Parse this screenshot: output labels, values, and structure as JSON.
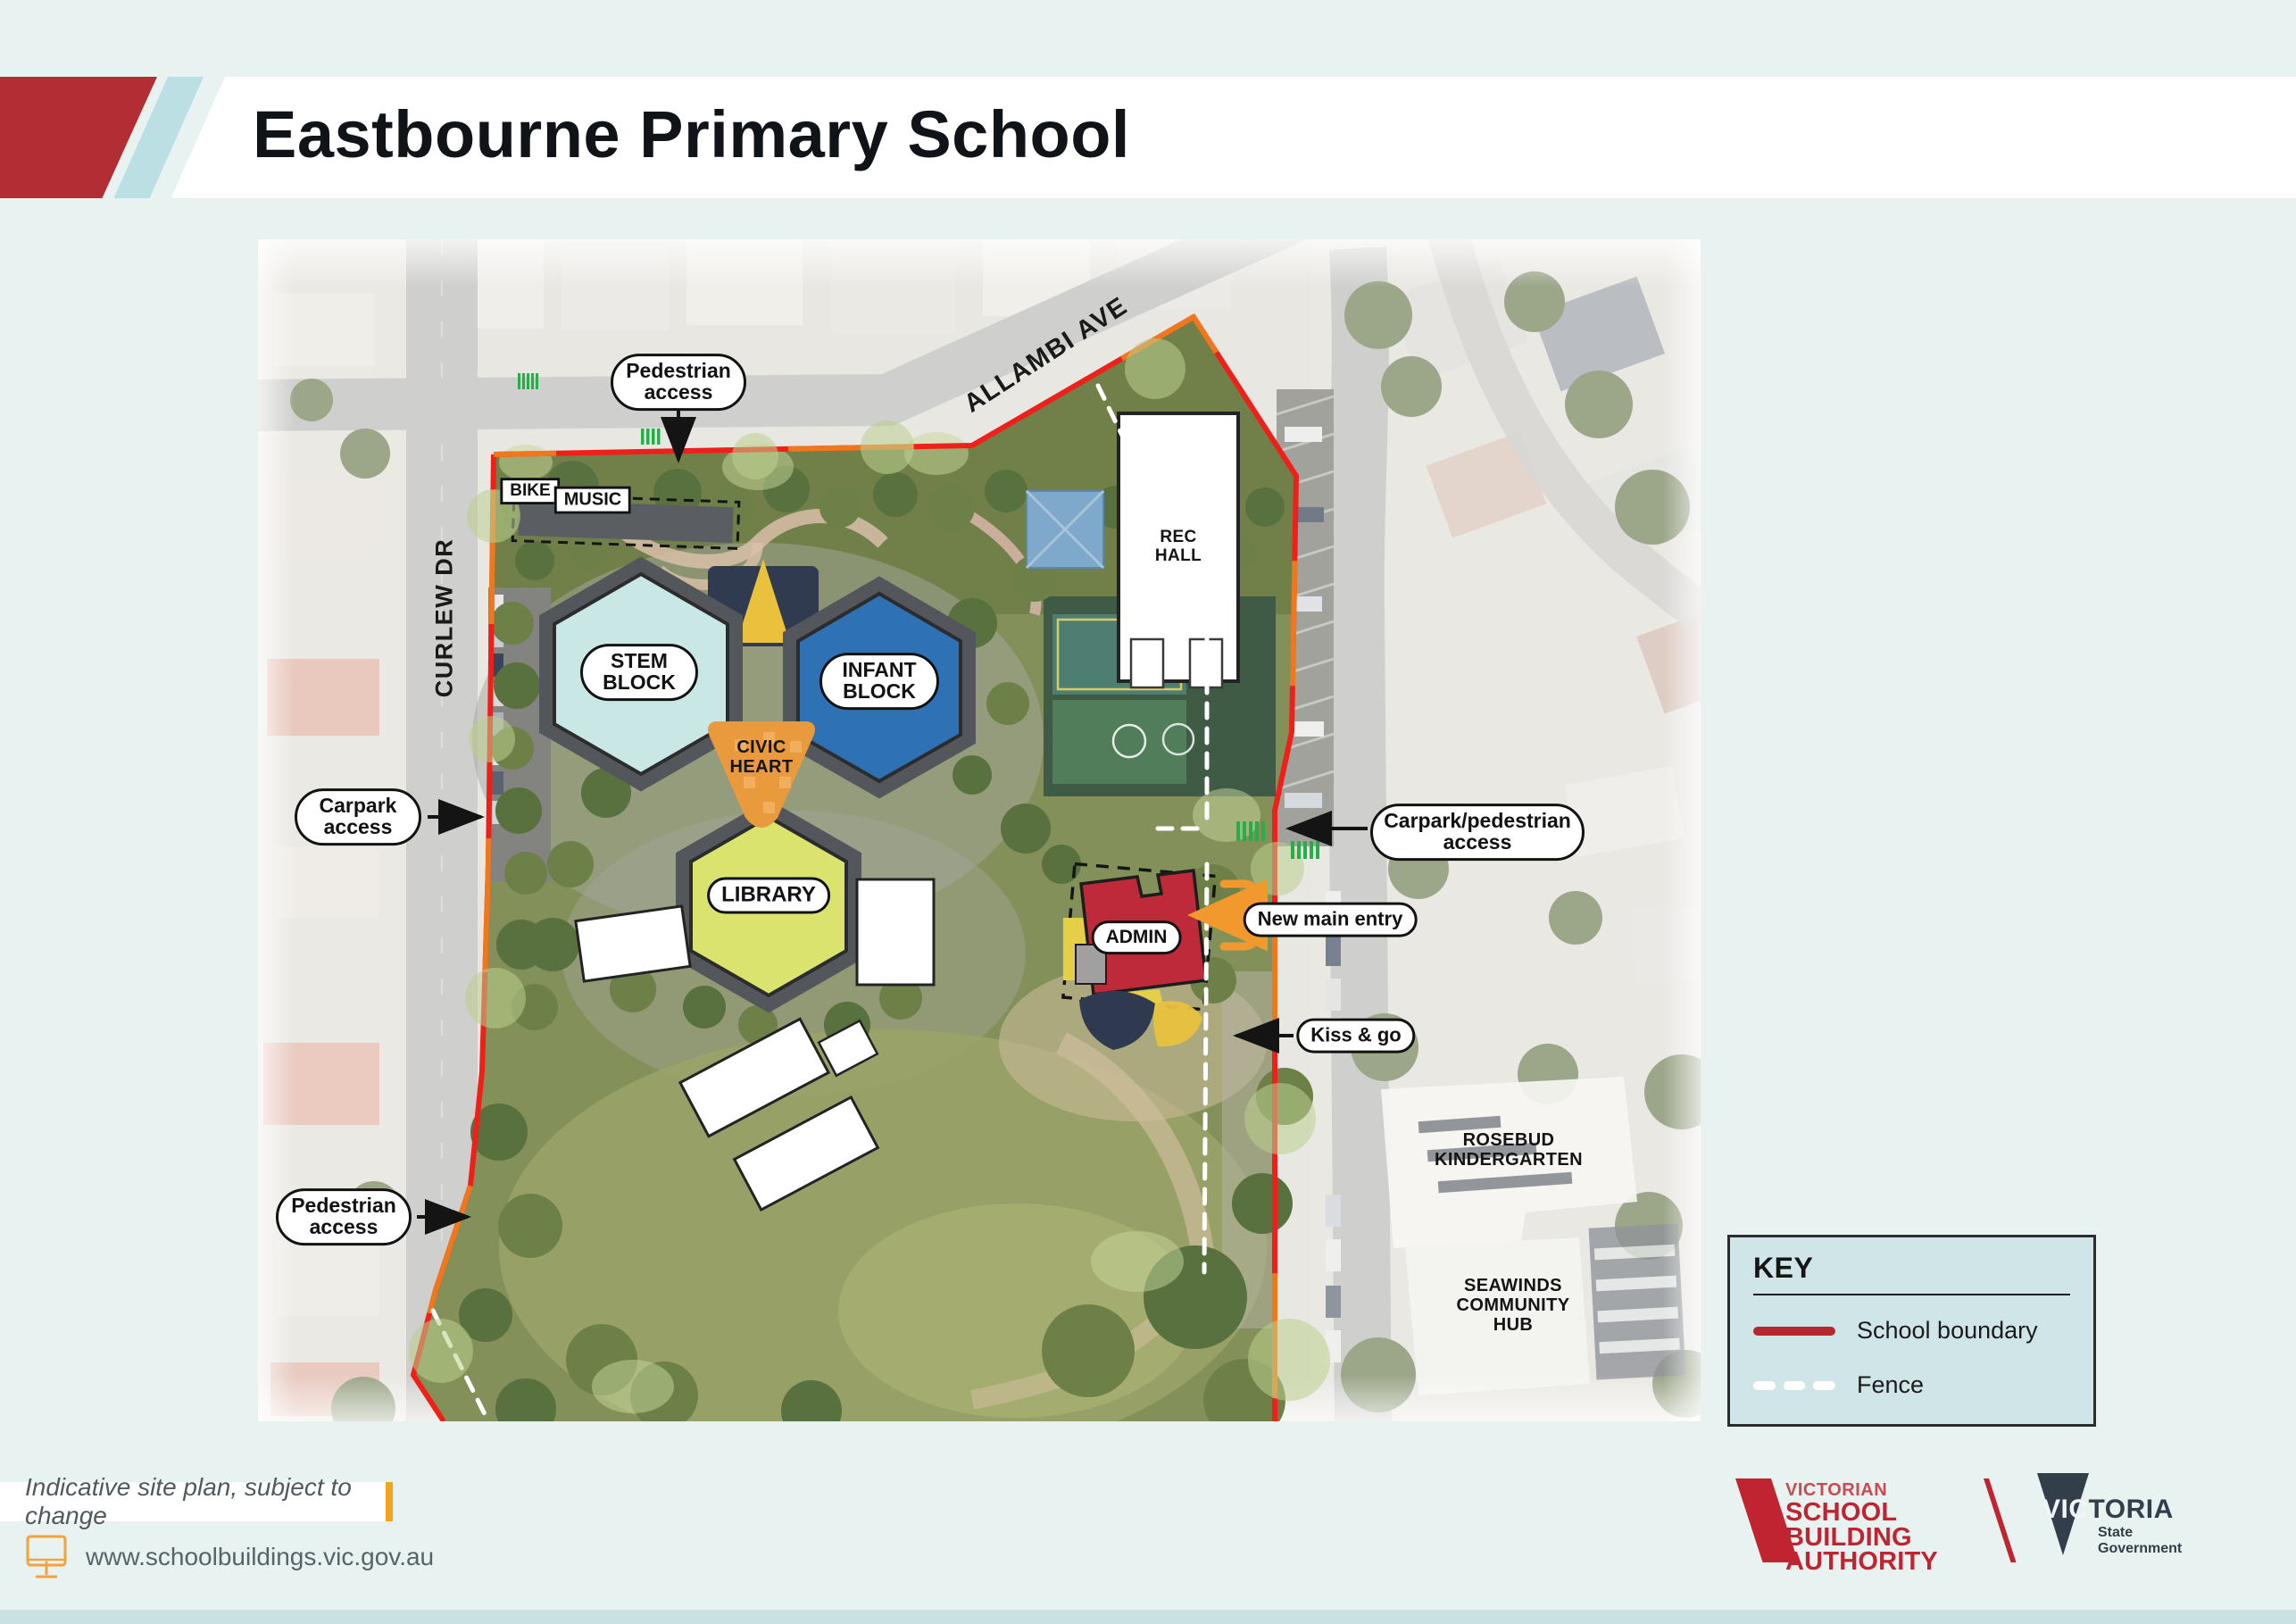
{
  "title": "Eastbourne Primary School",
  "map": {
    "streets": {
      "allambi_ave": "ALLAMBI AVE",
      "curlew_dr": "CURLEW DR"
    },
    "buildings": {
      "bike": "BIKE",
      "music": "MUSIC",
      "stem_block": "STEM BLOCK",
      "infant_block": "INFANT BLOCK",
      "civic_heart": "CIVIC HEART",
      "rec_hall": "REC HALL",
      "library": "LIBRARY",
      "admin": "ADMIN"
    },
    "neighbours": {
      "rosebud": "ROSEBUD KINDERGARTEN",
      "seawinds": "SEAWINDS COMMUNITY HUB"
    },
    "callouts": {
      "pedestrian_access_top": "Pedestrian access",
      "carpark_access": "Carpark access",
      "carpark_pedestrian_access": "Carpark/pedestrian access",
      "new_main_entry": "New main entry",
      "kiss_and_go": "Kiss & go",
      "pedestrian_access_bottom": "Pedestrian access"
    }
  },
  "key": {
    "title": "KEY",
    "items": [
      {
        "label": "School boundary",
        "swatch_color": "#b5282f",
        "swatch_style": "solid"
      },
      {
        "label": "Fence",
        "swatch_color": "#ffffff",
        "swatch_style": "dashed"
      }
    ]
  },
  "footer": {
    "disclaimer": "Indicative site plan, subject to change",
    "website": "www.schoolbuildings.vic.gov.au"
  },
  "logos": {
    "vsba": {
      "line1": "VICTORIAN",
      "line2": "SCHOOL BUILDING",
      "line3": "AUTHORITY"
    },
    "victoria": {
      "prefix": "VIC",
      "suffix": "TORIA",
      "sub_line1": "State",
      "sub_line2": "Government"
    }
  },
  "colors": {
    "page_background": "#e7f2f1",
    "banner_red": "#b22e34",
    "banner_stripe": "#bcdfe4",
    "boundary_red": "#ee2019",
    "boundary_orange": "#f07c1e",
    "fence_white": "#ffffff",
    "accent_orange": "#f5a21f",
    "stem_fill": "#c9e7e5",
    "infant_fill": "#2e72b5",
    "civic_fill": "#e89a3d",
    "library_fill": "#d9e36e",
    "admin_fill": "#bf2a3a",
    "crossing_green": "#27ae4b"
  }
}
